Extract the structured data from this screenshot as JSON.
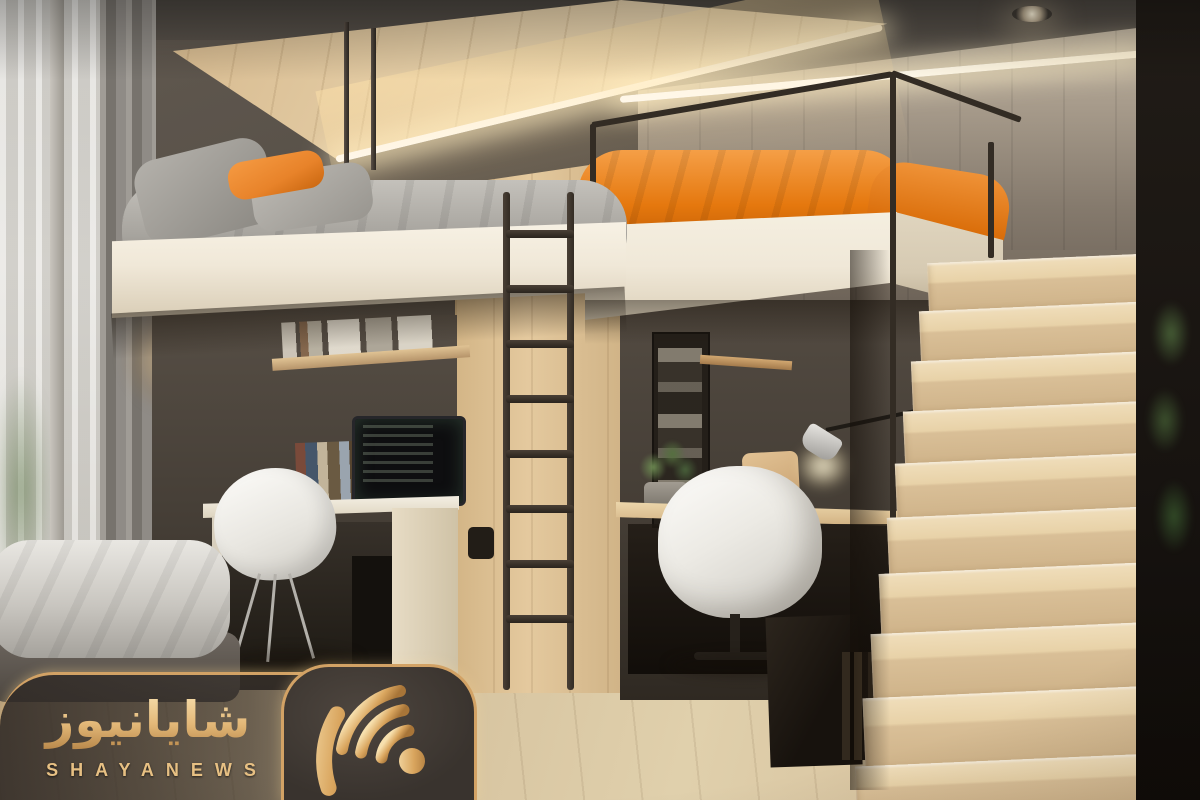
{
  "image": {
    "type": "interior-photo-render",
    "description": "Compact loft bedroom: two elevated beds (gray bedding left, orange duvet right) above twin study nooks with desks and white chairs, black metal ladder, light-wood staircase on the right, window with sheer curtain on the left, floor mattress at bottom left, news-agency watermark overlay.",
    "objects": [
      "ceiling-wood-canopy",
      "led-strip-lighting",
      "recessed-spotlight",
      "window-sheer-curtain",
      "gray-curtain",
      "left-loft-bed",
      "gray-bedding",
      "orange-pillow",
      "hanging-rods",
      "metal-ladder",
      "wood-column",
      "right-loft-bed",
      "orange-duvet",
      "metal-railing",
      "left-desk",
      "imac-monitor",
      "bookshelf",
      "white-shell-chair",
      "right-desk",
      "white-swivel-chair",
      "desk-lamp",
      "potted-plant",
      "storage-cabinet",
      "wood-staircase",
      "plant-shelf",
      "floor-mattress",
      "wood-floor"
    ]
  },
  "watermark": {
    "brand_latin": "SHAYANEWS",
    "brand_persian": "شایانیوز",
    "icon": "wifi-signal-icon"
  },
  "palette": {
    "gold": "#d2a265",
    "goldLight": "#f6dfae",
    "goldDeep": "#a87538",
    "wallDark": "#554e46",
    "wallRight": "#a89c8c",
    "wallRightDeep": "#6b6156",
    "woodCanopy": "#e8d2ab",
    "woodColumn": "#e4c99e",
    "woodFloor": "#d7c29e",
    "stairTread": "#f0debb",
    "stairRiser": "#d9bf97",
    "fascia": "#f0e8d8",
    "fasciaShade": "#d6cab2",
    "beddingGray": "#a7a49e",
    "pillowOrange": "#e8832a",
    "duvetOrange": "#e5780e",
    "metal": "#332c24",
    "led": "#fff3d6",
    "curtain": "#8f8b86",
    "sheer": "#e3e1dc",
    "green": "#5c7747"
  }
}
